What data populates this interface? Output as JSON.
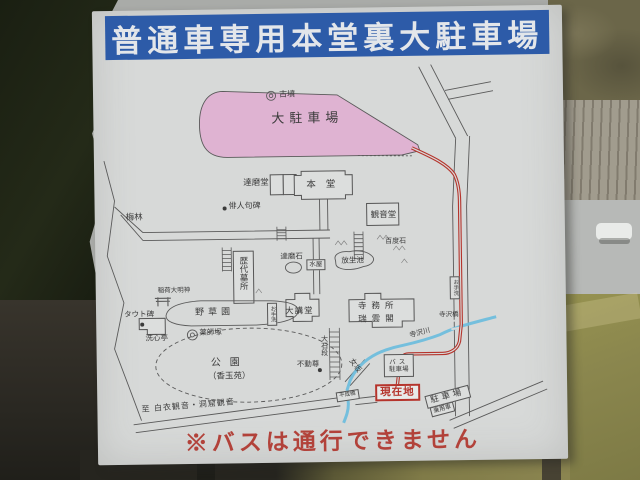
{
  "sign": {
    "title": "普通車専用本堂裏大駐車場",
    "warning": "※バスは通行できません",
    "colors": {
      "header_bg": "#2d5ba8",
      "parking_fill": "#dfb3d2",
      "route_red": "#b5342c",
      "river_blue": "#6fbedd",
      "warning_red": "#b2423a"
    },
    "map": {
      "labels": {
        "kofun": "古墳",
        "main_parking": "大駐車場",
        "darumado": "達磨堂",
        "hondo": "本堂",
        "haijin_kuhi": "俳人句碑",
        "kannondo": "観音堂",
        "hyakudoishi": "百度石",
        "hojoike": "放生池",
        "rekidai_bosho": "歴代墓所",
        "inari": "稲荷大明神",
        "bairin": "梅林",
        "yasoen": "野草園",
        "darumaishi": "達磨石",
        "mizuya": "水屋",
        "tauto_hi": "タウト碑",
        "senshintei": "洗心亭",
        "yakushizuka": "薬師塚",
        "koen": "公園",
        "kogyokuen": "（香玉苑）",
        "otearai": "お手洗",
        "daikodo": "大講堂",
        "jimusho": "寺務所",
        "zuiunkaku": "瑞雲閣",
        "fudoson": "不動尊",
        "oishidan": "大石段",
        "onnazaka": "女坂",
        "terasawabashi": "寺沢橋",
        "terasawagawa": "寺沢川",
        "bus_parking_1": "バス",
        "bus_parking_2": "駐車場",
        "genzaichi": "現在地",
        "heiseibashi": "平成橋",
        "chushajo": "駐車場",
        "joyosha": "乗用車",
        "to_kannon": "至 白衣観音・洞窟観音"
      }
    }
  }
}
